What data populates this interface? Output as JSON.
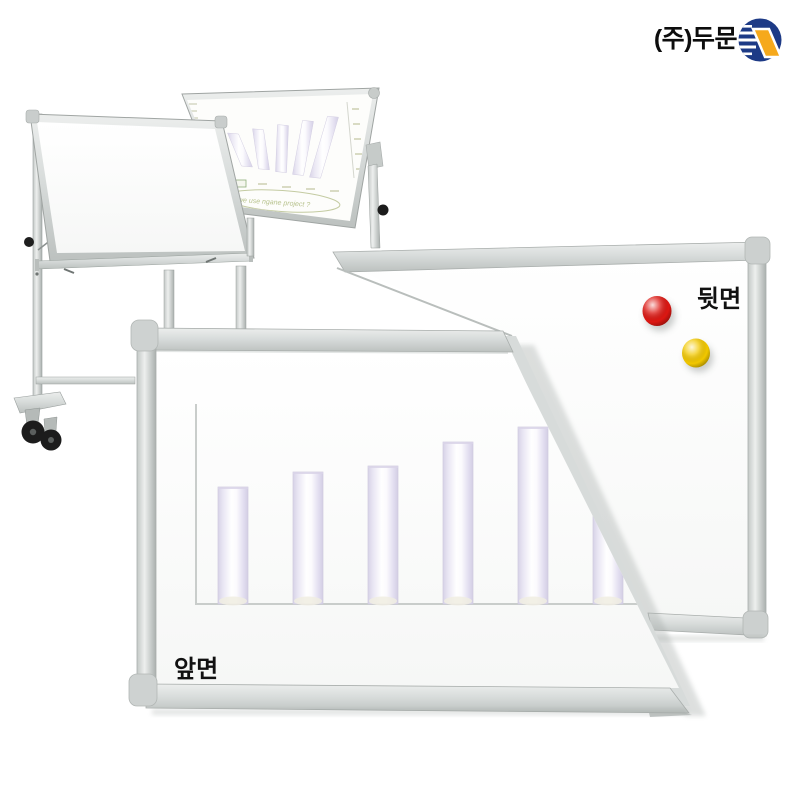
{
  "page": {
    "width": 800,
    "height": 800,
    "background": "#ffffff"
  },
  "brand": {
    "company_label": "(주)두문",
    "logo_colors": {
      "navy": "#1d3a86",
      "yellow": "#f6a91c"
    }
  },
  "boards": {
    "back": {
      "label": "뒷면",
      "magnets": {
        "red": "#dd1712",
        "yellow": "#f2c800"
      }
    },
    "front": {
      "label": "앞면"
    },
    "stand_front_tilted": {
      "label": ""
    }
  },
  "colors": {
    "frame_aluminum": "#d6d9d8",
    "frame_edge": "#a6abaa",
    "bar_fill": "#e6e2f2",
    "axis": "#c9cdcb"
  },
  "chart_data": [
    {
      "type": "bar",
      "location": "front-board",
      "title": "",
      "xlabel": "",
      "ylabel": "",
      "categories": [
        "",
        "",
        "",
        "",
        "",
        ""
      ],
      "values": [
        39,
        44,
        46,
        54,
        59,
        64
      ],
      "ylim": [
        0,
        70
      ],
      "grid": false,
      "legend": "none",
      "bar_color": "#e6e2f2",
      "axis_color": "#c9cdcb"
    },
    {
      "type": "bar",
      "location": "stand-rear-board",
      "title": "",
      "categories": [
        "",
        "",
        "",
        "",
        ""
      ],
      "values": [
        33,
        40,
        47,
        54,
        61
      ],
      "annotation": "we use ngane project ?",
      "bar_color": "#e6e2f2"
    }
  ]
}
